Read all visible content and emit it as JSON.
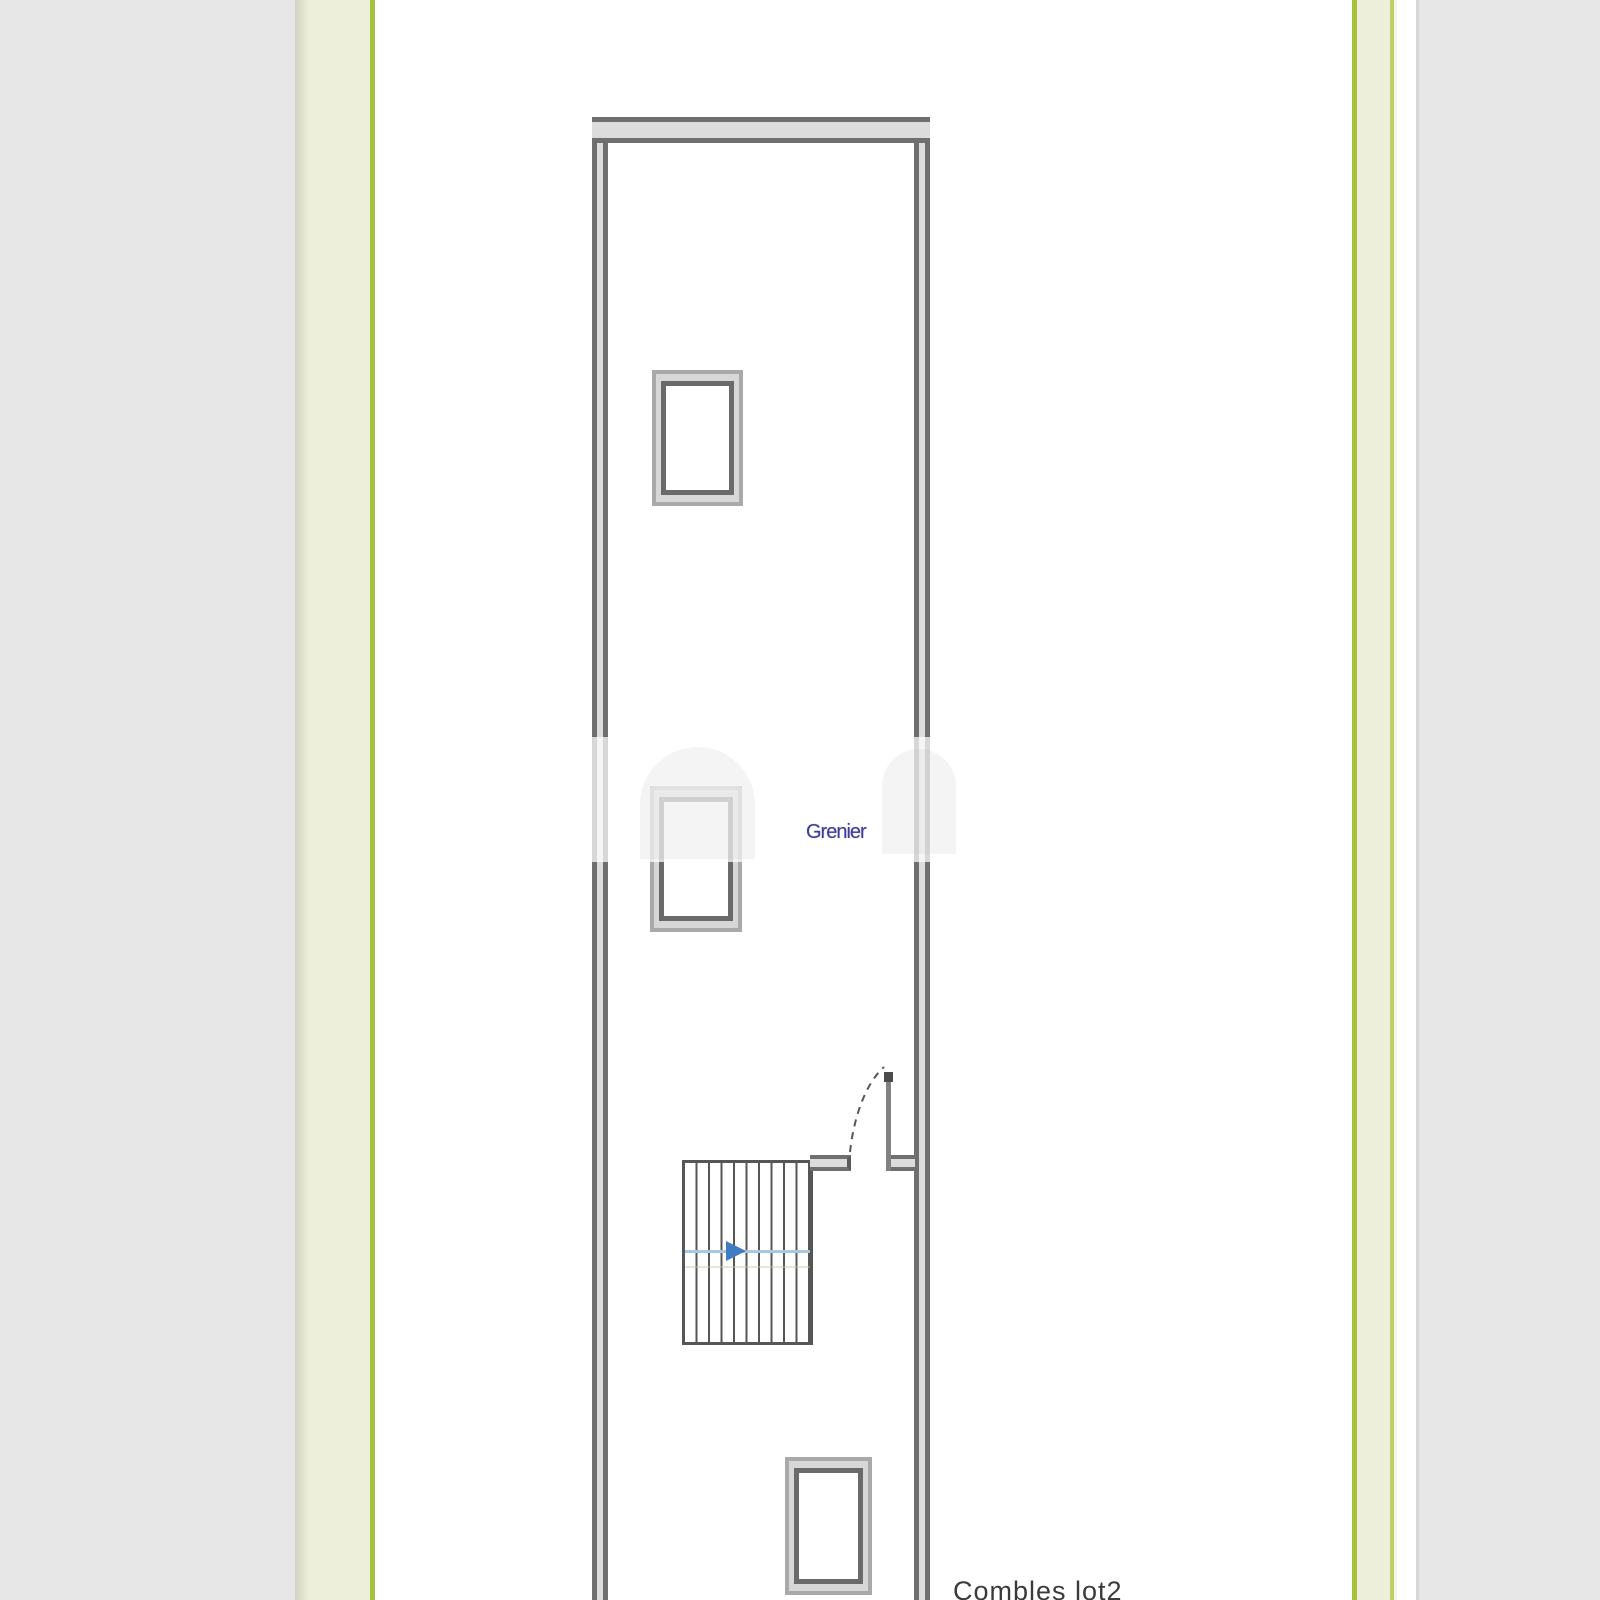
{
  "plan": {
    "room_label": "Grenier",
    "caption": "Combles lot2"
  },
  "colors": {
    "viewer-bg": "#e7e7e7",
    "paper": "#ffffff",
    "strip-pale": "#edefdb",
    "strip-pale-light": "#f3f5e4",
    "strip-green": "#a6c13d",
    "strip-green-light": "#bdd066",
    "wall-line": "#6f6f6f",
    "wall-fill": "#dcdcdc",
    "frame-outer": "#a9a9a9",
    "frame-fill": "#d7d7d7",
    "frame-inner": "#6a6a6a",
    "stair-line": "#565656",
    "arrow-blue": "#3f7cc4",
    "arrow-track": "#a9c7e2",
    "door-line": "#555555",
    "room-label-color": "#3d3d99",
    "caption-color": "#3a3a3a"
  }
}
